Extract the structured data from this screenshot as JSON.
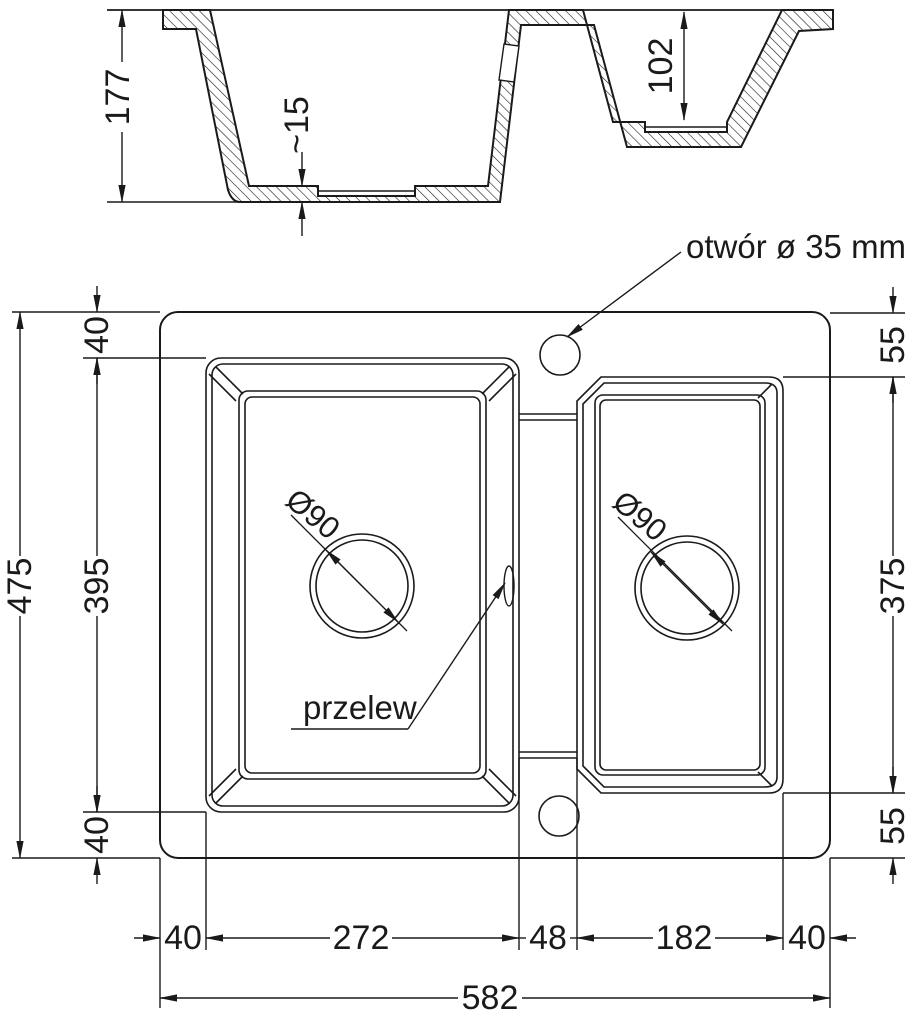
{
  "drawing_type": "sink-dimension-drawing",
  "labels": {
    "tap_hole": "otwór ø 35 mm",
    "overflow": "przelew"
  },
  "section_dims": {
    "total_depth": "177",
    "bottom_thickness": "~15",
    "small_bowl_depth": "102"
  },
  "plan_dims": {
    "total_height": "475",
    "total_width": "582",
    "left_top_margin": "40",
    "left_bowl_height": "395",
    "left_bottom_margin": "40",
    "right_top_margin": "55",
    "right_bowl_height": "375",
    "right_bottom_margin": "55",
    "bottom_left_margin": "40",
    "left_bowl_width": "272",
    "divider_width": "48",
    "right_bowl_width": "182",
    "bottom_right_margin": "40",
    "left_drain": "Ø90",
    "right_drain": "Ø90"
  },
  "colors": {
    "line": "#1a1a1a",
    "background": "#ffffff"
  }
}
